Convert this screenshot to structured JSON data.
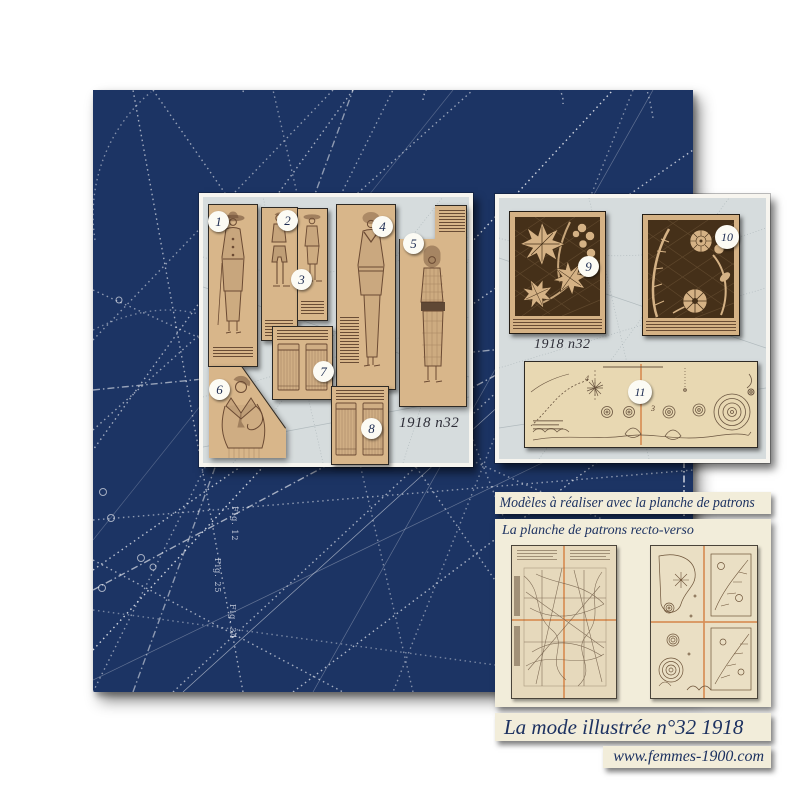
{
  "poster": {
    "bands": {
      "models": "Modèles à réaliser avec la planche de patrons",
      "planche": "La planche de patrons recto-verso",
      "title": "La mode illustrée n°32 1918",
      "website": "www.femmes-1900.com"
    },
    "fashion_panel": {
      "edition": "1918 n32",
      "numbers": [
        "1",
        "2",
        "3",
        "4",
        "5",
        "6",
        "7",
        "8"
      ]
    },
    "embroidery_panel": {
      "edition": "1918 n32",
      "numbers": [
        "9",
        "10",
        "11"
      ],
      "sheet_piece_numbers": [
        "4",
        "3"
      ]
    },
    "background_labels": [
      "Fig. 22",
      "Fig. 25",
      "Fig. 34",
      "Fig. 12",
      "Fig. 31"
    ],
    "colors": {
      "navy": "#1c3464",
      "panel_gray": "#d6dcdd",
      "cream": "#f2edda",
      "sepia": "#d8b68a",
      "lace_dark": "#453019",
      "fold_orange": "#d89057"
    }
  }
}
